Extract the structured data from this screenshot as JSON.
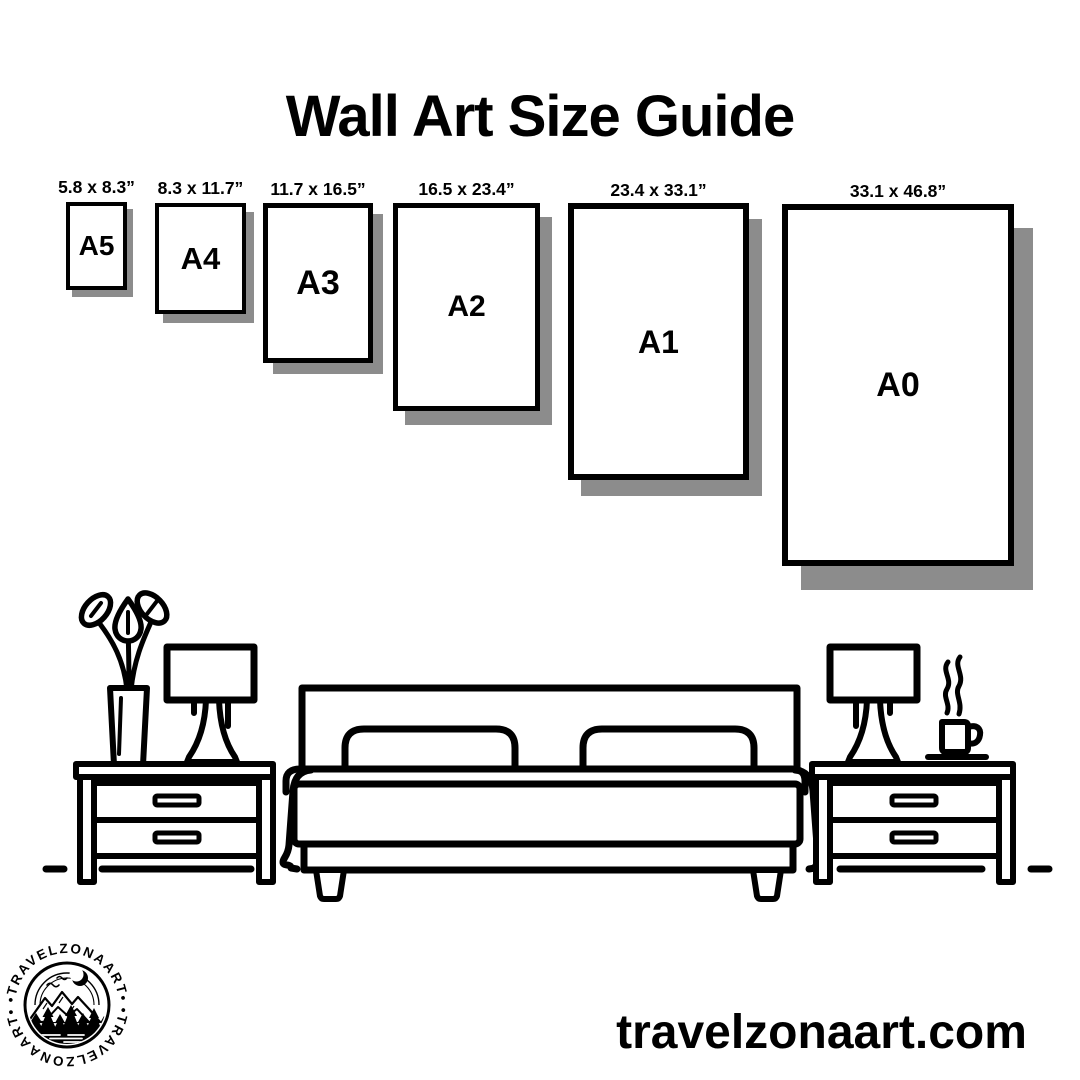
{
  "title": "Wall Art Size Guide",
  "sizes": [
    {
      "name": "A5",
      "dimensions": "5.8 x 8.3”"
    },
    {
      "name": "A4",
      "dimensions": "8.3 x 11.7”"
    },
    {
      "name": "A3",
      "dimensions": "11.7 x 16.5”"
    },
    {
      "name": "A2",
      "dimensions": "16.5 x 23.4”"
    },
    {
      "name": "A1",
      "dimensions": "23.4 x 33.1”"
    },
    {
      "name": "A0",
      "dimensions": "33.1 x 46.8”"
    }
  ],
  "branding": {
    "website": "travelzonaart.com",
    "logo_ring_text": "•TRAVELZONAART•"
  },
  "illustration": {
    "icons": [
      "plant-vase-icon",
      "table-lamp-icon",
      "bed-icon",
      "nightstand-icon",
      "coffee-cup-icon",
      "logo-badge-icon"
    ]
  },
  "colors": {
    "ink": "#000000",
    "shadow": "#8c8c8c",
    "background": "#ffffff"
  }
}
